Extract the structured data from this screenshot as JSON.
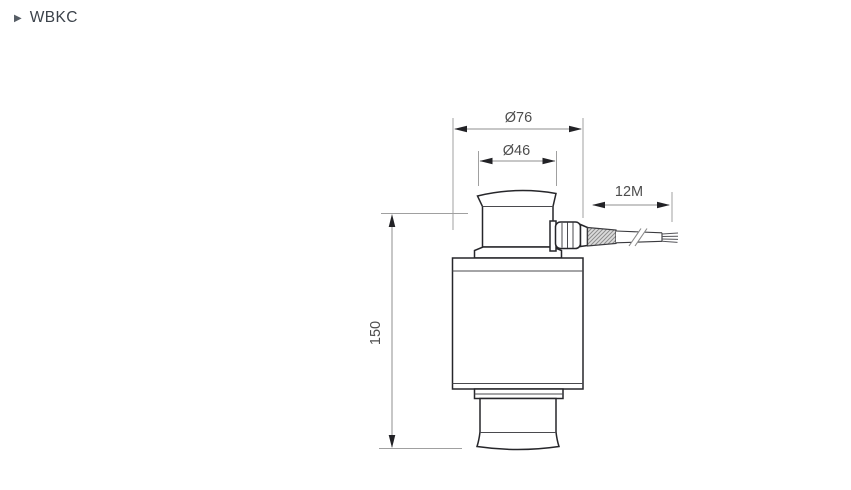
{
  "header": {
    "title": "WBKC",
    "bullet_icon": "triangle-right"
  },
  "drawing": {
    "kind": "load-cell-side-view-technical-drawing",
    "labels": {
      "outer_diameter": "Ø76",
      "top_diameter": "Ø46",
      "cable_length": "12M",
      "height": "150"
    }
  },
  "colors": {
    "bg": "#ffffff",
    "outline": "#26262a",
    "dim": "#8f8f8f",
    "ext": "#a0a0a0",
    "arrow": "#222226",
    "text": "#4d4d4d",
    "title": "#3b424a"
  }
}
